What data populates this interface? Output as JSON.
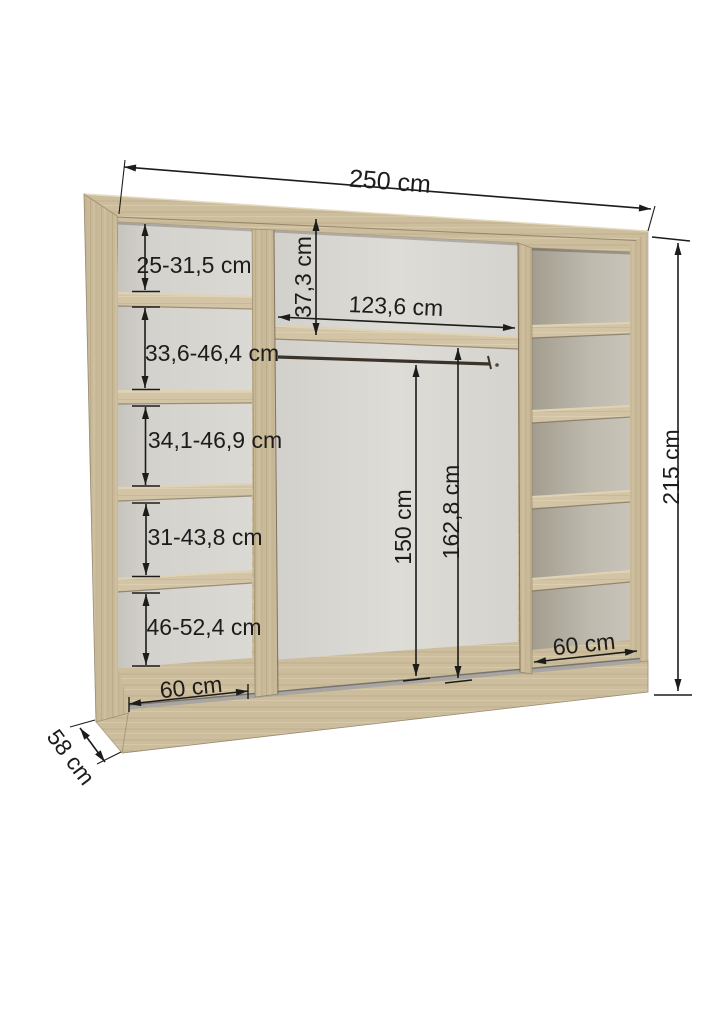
{
  "diagram": {
    "title": "Wardrobe interior dimension diagram",
    "unit": "cm",
    "labels": {
      "total_width": "250 cm",
      "total_height": "215 cm",
      "depth": "58 cm",
      "left_shelf_1": "25-31,5 cm",
      "left_shelf_2": "33,6-46,4 cm",
      "left_shelf_3": "34,1-46,9 cm",
      "left_shelf_4": "31-43,8 cm",
      "left_shelf_5": "46-52,4 cm",
      "left_column_width": "60 cm",
      "top_gap_height": "37,3 cm",
      "middle_width": "123,6 cm",
      "rail_height": "150 cm",
      "middle_height": "162,8 cm",
      "right_column_width": "60 cm"
    },
    "colors": {
      "wood": "#c9ba9b",
      "wood_light": "#d3c5a6",
      "wood_dark": "#bcac8c",
      "back_panel": "#d6d4cf",
      "back_panel_dark": "#aaa499",
      "track": "#8e8b86",
      "dimension_line": "#1c1c1a",
      "background": "#ffffff"
    }
  }
}
